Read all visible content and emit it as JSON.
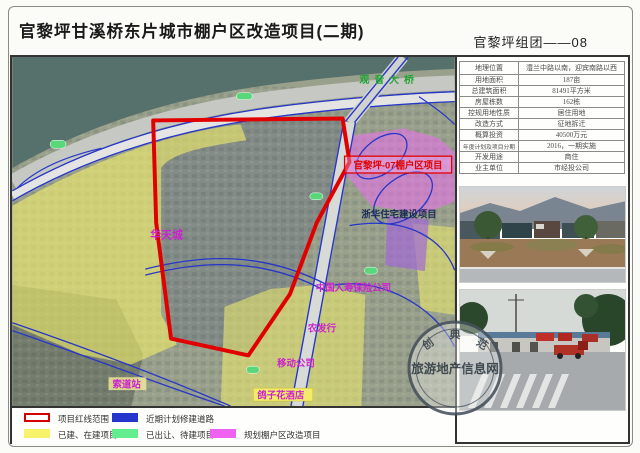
{
  "header": {
    "title": "官黎坪甘溪桥东片城市棚户区改造项目(二期)",
    "code": "官黎坪组团——08"
  },
  "info_table": {
    "rows": [
      {
        "label": "地理位置",
        "value": "澧兰中路以南，迎宾南路以西"
      },
      {
        "label": "用地面积",
        "value": "187亩"
      },
      {
        "label": "总建筑面积",
        "value": "81491平方米"
      },
      {
        "label": "房屋栋数",
        "value": "162栋"
      },
      {
        "label": "控规用地性质",
        "value": "居住用地"
      },
      {
        "label": "改造方式",
        "value": "征地拆迁"
      },
      {
        "label": "概算投资",
        "value": "40500万元"
      },
      {
        "label": "年度计划及项目分期",
        "value": "2016，一期实施"
      },
      {
        "label": "开发用途",
        "value": "商住"
      },
      {
        "label": "业主单位",
        "value": "市经投公司"
      }
    ]
  },
  "map": {
    "labels": {
      "bridge": "观音大桥",
      "project07": "官黎坪-07棚户区项目",
      "zhehua": "浙华住宅建设项目",
      "huatian": "华天城",
      "renshou": "中国人寿保险公司",
      "nongfahang": "农发行",
      "yidong": "移动公司",
      "suodao": "索道站",
      "gezihua": "鸽子花酒店"
    }
  },
  "legend": {
    "items": [
      {
        "label": "项目红线范围",
        "color": "#d40000"
      },
      {
        "label": "近期计划修建道路",
        "color": "#2636cc"
      },
      {
        "label": "已建、在建项目",
        "color": "#f6f26a"
      },
      {
        "label": "已出让、待建项目",
        "color": "#62ee8e"
      },
      {
        "label": "规划棚户区改造项目",
        "color": "#ef62ef"
      }
    ]
  },
  "watermark": {
    "center": "旅游地产信息网",
    "arc": [
      "创",
      "典",
      "范"
    ]
  },
  "colors": {
    "boundary_red": "#e10000",
    "road_blue": "#2636c8",
    "water": "#56706b",
    "overlay_yellow": "#f1ee6b",
    "overlay_magenta": "#ee6ff0",
    "overlay_violet": "#a36ad6",
    "overlay_green": "#62ee8e"
  }
}
